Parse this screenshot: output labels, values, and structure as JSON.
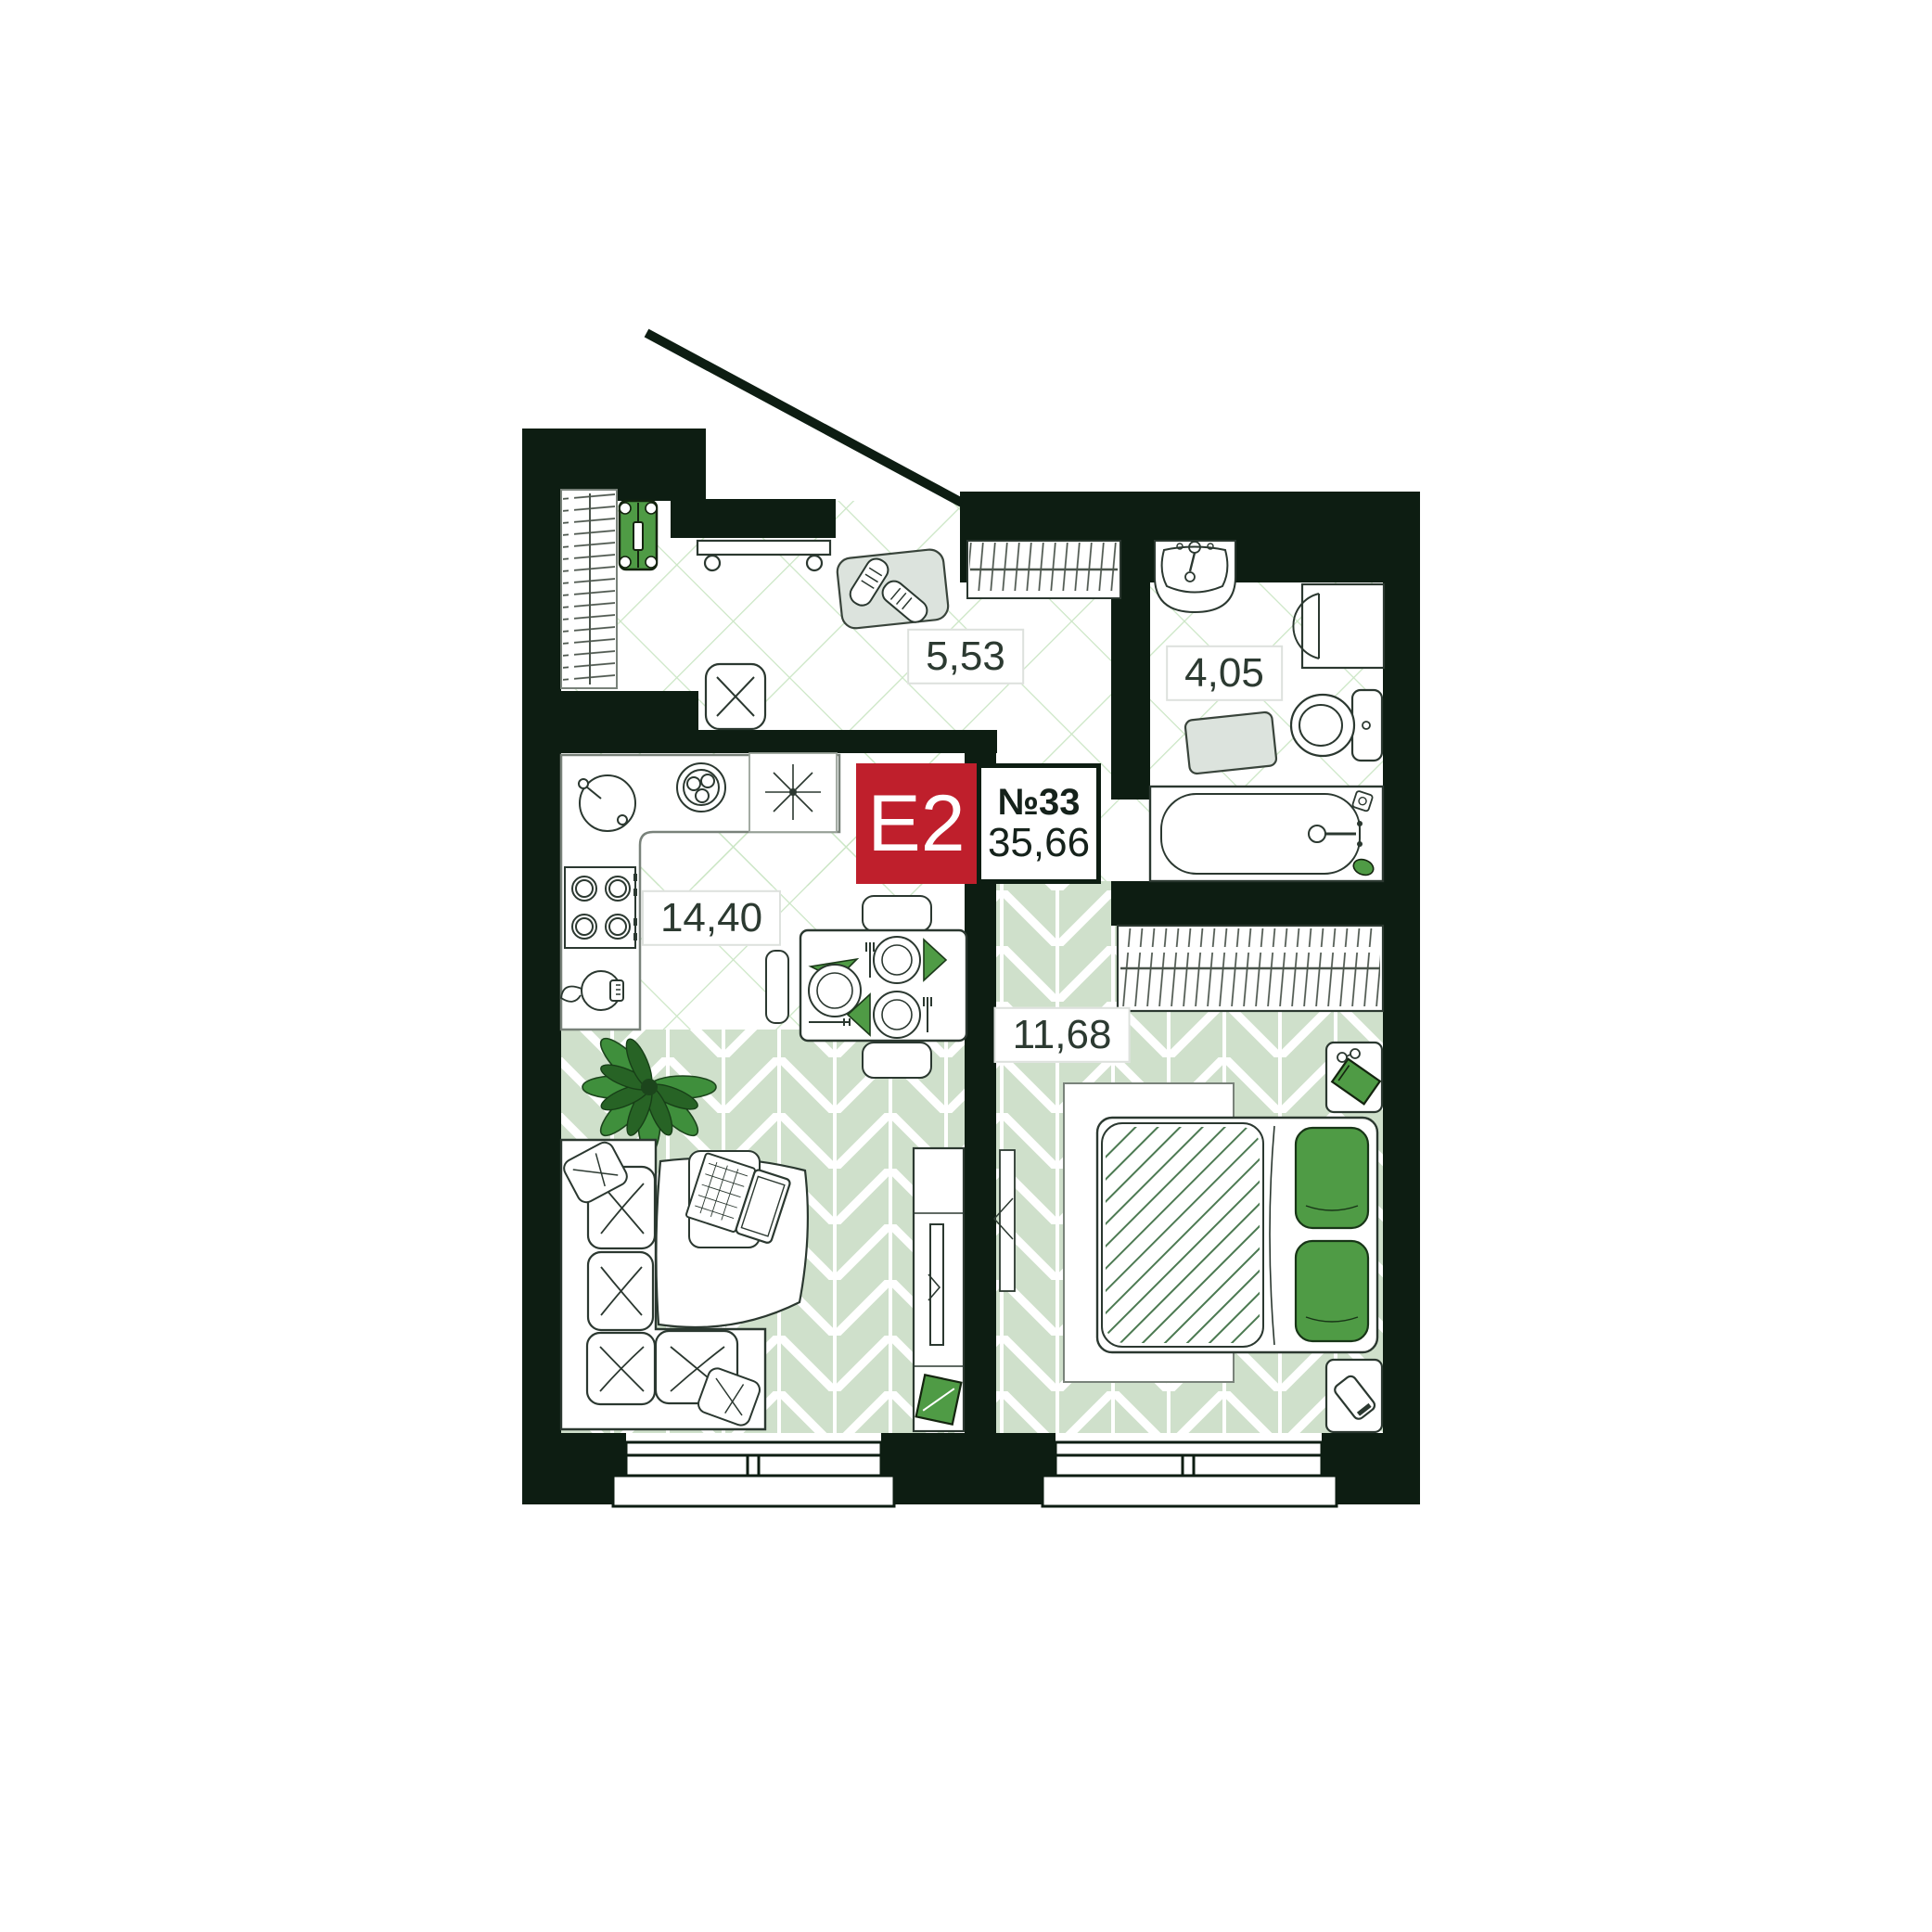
{
  "badge": {
    "type_label": "E2",
    "number_label": "№33",
    "total_area": "35,66",
    "type_bg": "#bf1f2c"
  },
  "rooms": [
    {
      "id": "hallway",
      "area": "5,53"
    },
    {
      "id": "bathroom",
      "area": "4,05"
    },
    {
      "id": "kitchen-living",
      "area": "14,40"
    },
    {
      "id": "bedroom",
      "area": "11,68"
    }
  ],
  "colors": {
    "wall": "#0d1d12",
    "outline": "#2b3830",
    "floor_grid_line": "#cbe6c5",
    "parquet_green": "#cfe0cb",
    "accent_green": "#4f9b45",
    "accent_red": "#bf1f2c",
    "label_text": "#2c3a31",
    "mat_gray": "#dce3dd"
  },
  "furniture": {
    "hallway": [
      "closet-with-clothes",
      "suitcase",
      "bench",
      "shoe-rug",
      "pouf",
      "entry-shelf",
      "entrance-door"
    ],
    "kitchen_living": [
      "l-shaped-counter",
      "kitchen-sink",
      "fruit-bowl",
      "cooktop",
      "kettle",
      "light-symbol",
      "dining-table",
      "chairs",
      "plates",
      "napkins",
      "corner-sofa",
      "pillows",
      "throw-blanket",
      "laptop",
      "plant",
      "tv-stand",
      "tv",
      "storage-box",
      "window"
    ],
    "bedroom": [
      "wardrobe",
      "double-bed",
      "duvet",
      "green-pillows",
      "rug",
      "nightstand-with-book-and-glasses",
      "nightstand-with-phone",
      "door-leaf",
      "window"
    ],
    "bathroom": [
      "washbasin",
      "washing-machine",
      "toilet",
      "bath-mat",
      "bathtub",
      "soap"
    ]
  }
}
